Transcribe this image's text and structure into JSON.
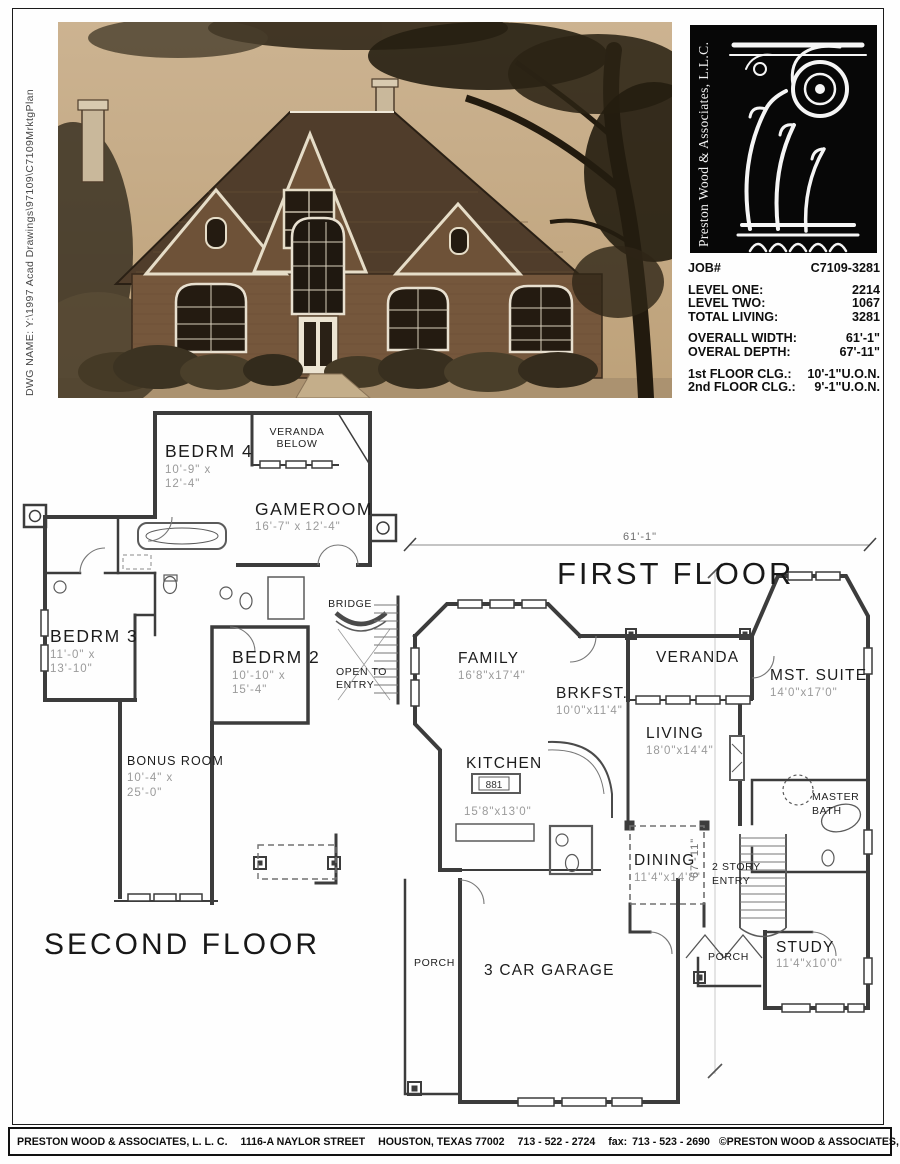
{
  "sheet": {
    "dwg_name": "DWG NAME: Y:\\1997 Acad Drawings\\97109\\C7109MrktgPlan"
  },
  "logo": {
    "company_vertical": "Preston Wood & Associates, L.L.C."
  },
  "title_block": {
    "job_label": "JOB#",
    "job_value": "C7109-3281",
    "area_rows": [
      {
        "label": "LEVEL ONE:",
        "value": "2214"
      },
      {
        "label": "LEVEL TWO:",
        "value": "1067"
      },
      {
        "label": "TOTAL LIVING:",
        "value": "3281"
      }
    ],
    "dim_rows": [
      {
        "label": "OVERALL WIDTH:",
        "value": "61'-1\""
      },
      {
        "label": "OVERAL DEPTH:",
        "value": "67'-11\""
      }
    ],
    "clg_rows": [
      {
        "label": "1st FLOOR CLG.:",
        "value": "10'-1\"U.O.N."
      },
      {
        "label": "2nd FLOOR CLG.:",
        "value": "9'-1\"U.O.N."
      }
    ]
  },
  "plans": {
    "second": {
      "title": "SECOND FLOOR",
      "rooms": {
        "bedrm4": {
          "name": "BEDRM 4",
          "d1": "10'-9\" x",
          "d2": "12'-4\""
        },
        "veranda1": "VERANDA",
        "veranda2": "BELOW",
        "gameroom": {
          "name": "GAMEROOM",
          "d1": "16'-7\" x 12'-4\""
        },
        "bedrm3": {
          "name": "BEDRM 3",
          "d1": "11'-0\" x",
          "d2": "13'-10\""
        },
        "bedrm2": {
          "name": "BEDRM 2",
          "d1": "10'-10\" x",
          "d2": "15'-4\""
        },
        "bridge": "BRIDGE",
        "open1": "OPEN TO",
        "open2": "ENTRY",
        "bonus": {
          "name": "BONUS ROOM",
          "d1": "10'-4\" x",
          "d2": "25'-0\""
        }
      }
    },
    "first": {
      "title": "FIRST FLOOR",
      "width_dim": "61'-1\"",
      "depth_dim": "67'-11\"",
      "rooms": {
        "family": {
          "name": "FAMILY",
          "d1": "16'8\"x17'4\""
        },
        "veranda": "VERANDA",
        "mst": {
          "name": "MST. SUITE",
          "d1": "14'0\"x17'0\""
        },
        "brkfst": {
          "name": "BRKFST.",
          "d1": "10'0\"x11'4\""
        },
        "living": {
          "name": "LIVING",
          "d1": "18'0\"x14'4\""
        },
        "kitchen": {
          "name": "KITCHEN",
          "d1": "15'8\"x13'0\"",
          "cooktop": "881"
        },
        "mbath1": "MASTER",
        "mbath2": "BATH",
        "dining": {
          "name": "DINING",
          "d1": "11'4\"x14'8\""
        },
        "entry1": "2 STORY",
        "entry2": "ENTRY",
        "study": {
          "name": "STUDY",
          "d1": "11'4\"x10'0\""
        },
        "porch_left": "PORCH",
        "garage": "3 CAR GARAGE",
        "porch_right": "PORCH"
      }
    }
  },
  "footer": {
    "company": "PRESTON WOOD & ASSOCIATES, L. L. C.",
    "address": "1116-A  NAYLOR STREET",
    "city": "HOUSTON, TEXAS  77002",
    "phone": "713 - 522 - 2724",
    "fax_label": "fax:",
    "fax": "713 - 523 - 2690",
    "copyright": "©PRESTON WOOD & ASSOCIATES, L. L. C.  COPYRIGHT"
  }
}
